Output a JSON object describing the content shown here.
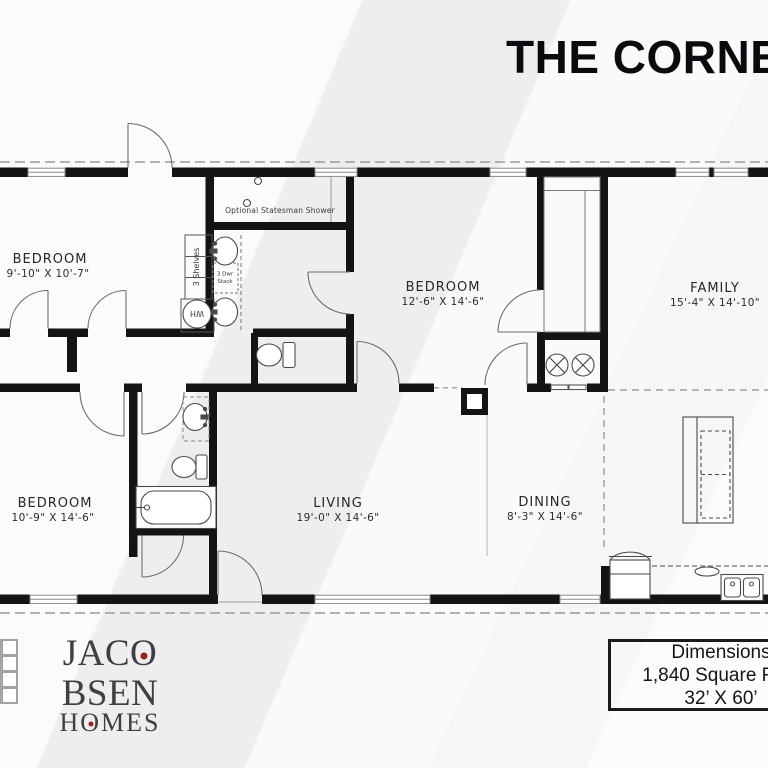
{
  "title": "THE CORNER",
  "plan": {
    "rooms": [
      {
        "name": "BEDROOM",
        "dims": "9'-10\" X 10'-7\""
      },
      {
        "name": "BEDROOM",
        "dims": "12'-6\" X 14'-6\""
      },
      {
        "name": "FAMILY",
        "dims": "15'-4\" X 14'-10\""
      },
      {
        "name": "BEDROOM",
        "dims": "10'-9\" X 14'-6\""
      },
      {
        "name": "LIVING",
        "dims": "19'-0\" X 14'-6\""
      },
      {
        "name": "DINING",
        "dims": "8'-3\" X 14'-6\""
      }
    ],
    "annotations": {
      "shower": "Optional Statesman Shower",
      "shelves": "3 Shelves",
      "stack_line1": "3 Dwr",
      "stack_line2": "Stack",
      "water_heater": "WH"
    }
  },
  "branding": {
    "line1_parts": [
      "JAC",
      "O",
      "BSEN"
    ],
    "line2_parts": [
      "H",
      "O",
      "MES"
    ],
    "dot_color": "#9e1f24",
    "text_color": "#3f3f45"
  },
  "spec_box": {
    "line1": "Dimensions",
    "line2": "1,840 Square Feet",
    "line3": "32’ X 60’"
  },
  "colors": {
    "wall": "#141414",
    "background": "#f3f3f4",
    "linework": "#4a4a4a",
    "accent_red": "#9e1f24"
  }
}
